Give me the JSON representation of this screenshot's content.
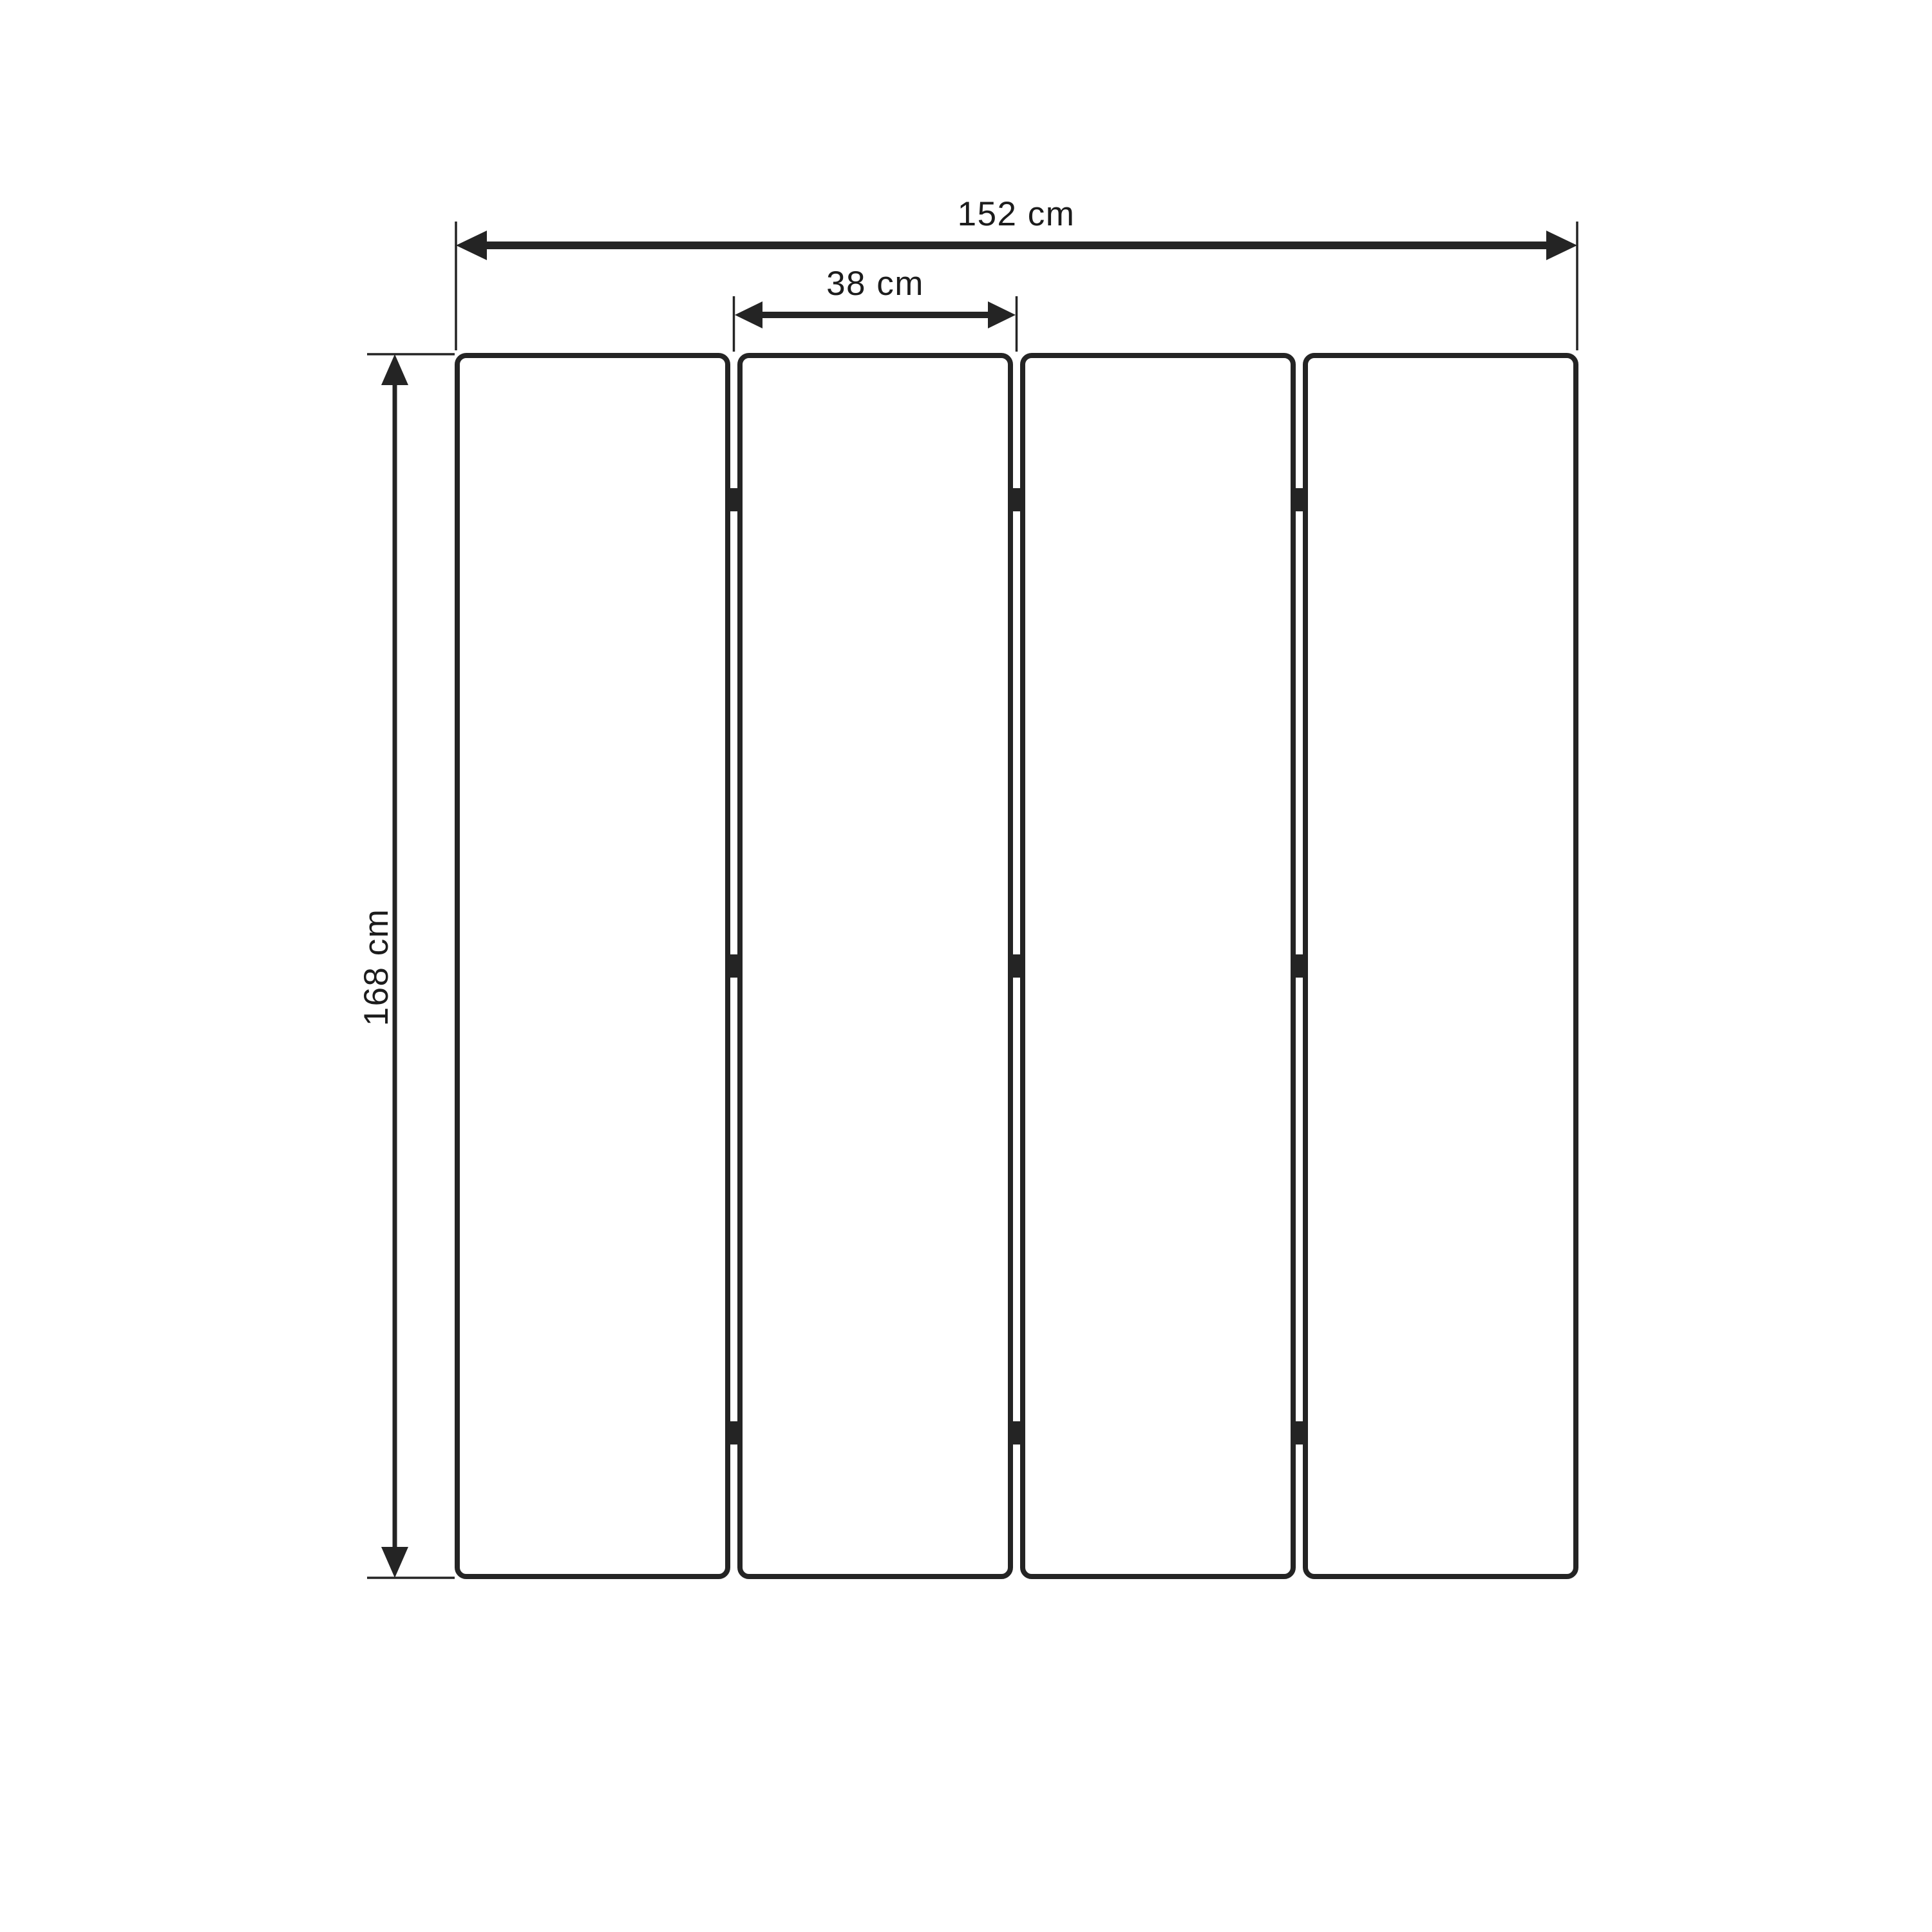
{
  "diagram": {
    "kind": "technical-dimension-drawing",
    "subject": "four-panel folding screen, front elevation",
    "panel_count": 4,
    "hinges_per_gap": 3,
    "labels": {
      "total_width": "152 cm",
      "panel_width": "38 cm",
      "height": "168 cm"
    },
    "colors": {
      "stroke": "#242424",
      "text": "#1c1c1c",
      "background": "#ffffff"
    }
  }
}
